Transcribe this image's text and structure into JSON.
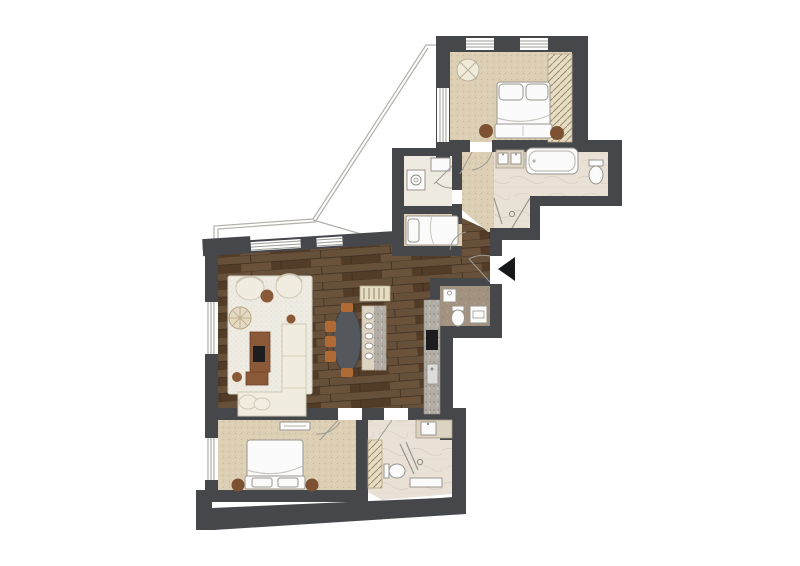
{
  "meta": {
    "title": "Apartment floor plan",
    "view": "top-down furnished plan",
    "visible_text": []
  },
  "palette": {
    "wall": "#45474b",
    "wall_dark": "#2f3134",
    "wood": "#5d4530",
    "wood_stripe_a": "#66503a",
    "wood_stripe_b": "#523c28",
    "wood_joint": "#3c2d1e",
    "carpet": "#ddcfb4",
    "carpet_dot": "#c9b795",
    "rug": "#eeebe2",
    "rug_dot": "#ded8c8",
    "marble": "#e9e1d6",
    "marble_vein": "#d5c9bb",
    "tile_taupe": "#a3927f",
    "tile_taupe_dot": "#8f7f6c",
    "laundry_floor": "#efeae0",
    "fixture_white": "#fbfbfb",
    "furniture_cream": "#f1ece0",
    "wood_furniture": "#8a5a38",
    "nightstand_brown": "#7d5233",
    "chair_orange": "#b06a33",
    "table_dark": "#54575c",
    "counter_granite": "#b2aea6",
    "granite_dot": "#8b877f",
    "cooktop_black": "#1d1d1f",
    "closet_beige": "#e7dcc4",
    "hatch_line": "#9b8a6d",
    "entrance_black": "#17181a",
    "line": "#b3b0aa"
  },
  "rooms": [
    {
      "id": "master-bedroom",
      "floor": "carpet",
      "position": "top-right"
    },
    {
      "id": "ensuite-bathroom",
      "floor": "marble",
      "position": "right, below master bedroom"
    },
    {
      "id": "shower-nook",
      "floor": "marble",
      "position": "below ensuite"
    },
    {
      "id": "corridor",
      "floor": "carpet",
      "position": "center-right"
    },
    {
      "id": "laundry-room",
      "floor": "tile",
      "position": "center"
    },
    {
      "id": "small-bedroom",
      "floor": "carpet",
      "position": "center"
    },
    {
      "id": "living-dining-kitchen",
      "floor": "dark-wood",
      "position": "center-left"
    },
    {
      "id": "guest-wc",
      "floor": "taupe-tile",
      "position": "right of kitchen, at entrance"
    },
    {
      "id": "bedroom-2",
      "floor": "carpet",
      "position": "bottom-left"
    },
    {
      "id": "bathroom-2",
      "floor": "marble",
      "position": "bottom-center"
    },
    {
      "id": "terrace",
      "floor": "none",
      "position": "top-left outline"
    }
  ],
  "furniture": {
    "master-bedroom": [
      "double-bed",
      "pillows",
      "nightstand-left",
      "nightstand-right",
      "wardrobe",
      "round-chair"
    ],
    "ensuite-bathroom": [
      "double-vanity",
      "bathtub",
      "toilet",
      "shower"
    ],
    "laundry-room": [
      "washing-machine",
      "shower-tray"
    ],
    "small-bedroom": [
      "single-bed"
    ],
    "living-dining-kitchen": [
      "area-rug",
      "armchair-1",
      "armchair-2",
      "woven-pouf",
      "side-table-1",
      "side-table-2",
      "side-table-3",
      "media-console",
      "tv",
      "l-shaped-sofa",
      "dining-table",
      "dining-chairs-x5",
      "kitchen-island",
      "bar-cabinet",
      "kitchen-counter",
      "cooktop",
      "kitchen-sink"
    ],
    "guest-wc": [
      "washbasin",
      "toilet",
      "washer-dryer"
    ],
    "bedroom-2": [
      "double-bed",
      "nightstand-left",
      "nightstand-right",
      "dresser"
    ],
    "bathroom-2": [
      "vanity-sink",
      "toilet",
      "shower",
      "bench",
      "linen-closet"
    ]
  },
  "markers": {
    "entrance": "black triangle arrow pointing left at right edge of hall",
    "doors": "thin quarter-circle swing lines",
    "windows": "white gaps with triple sill lines in dark walls"
  }
}
